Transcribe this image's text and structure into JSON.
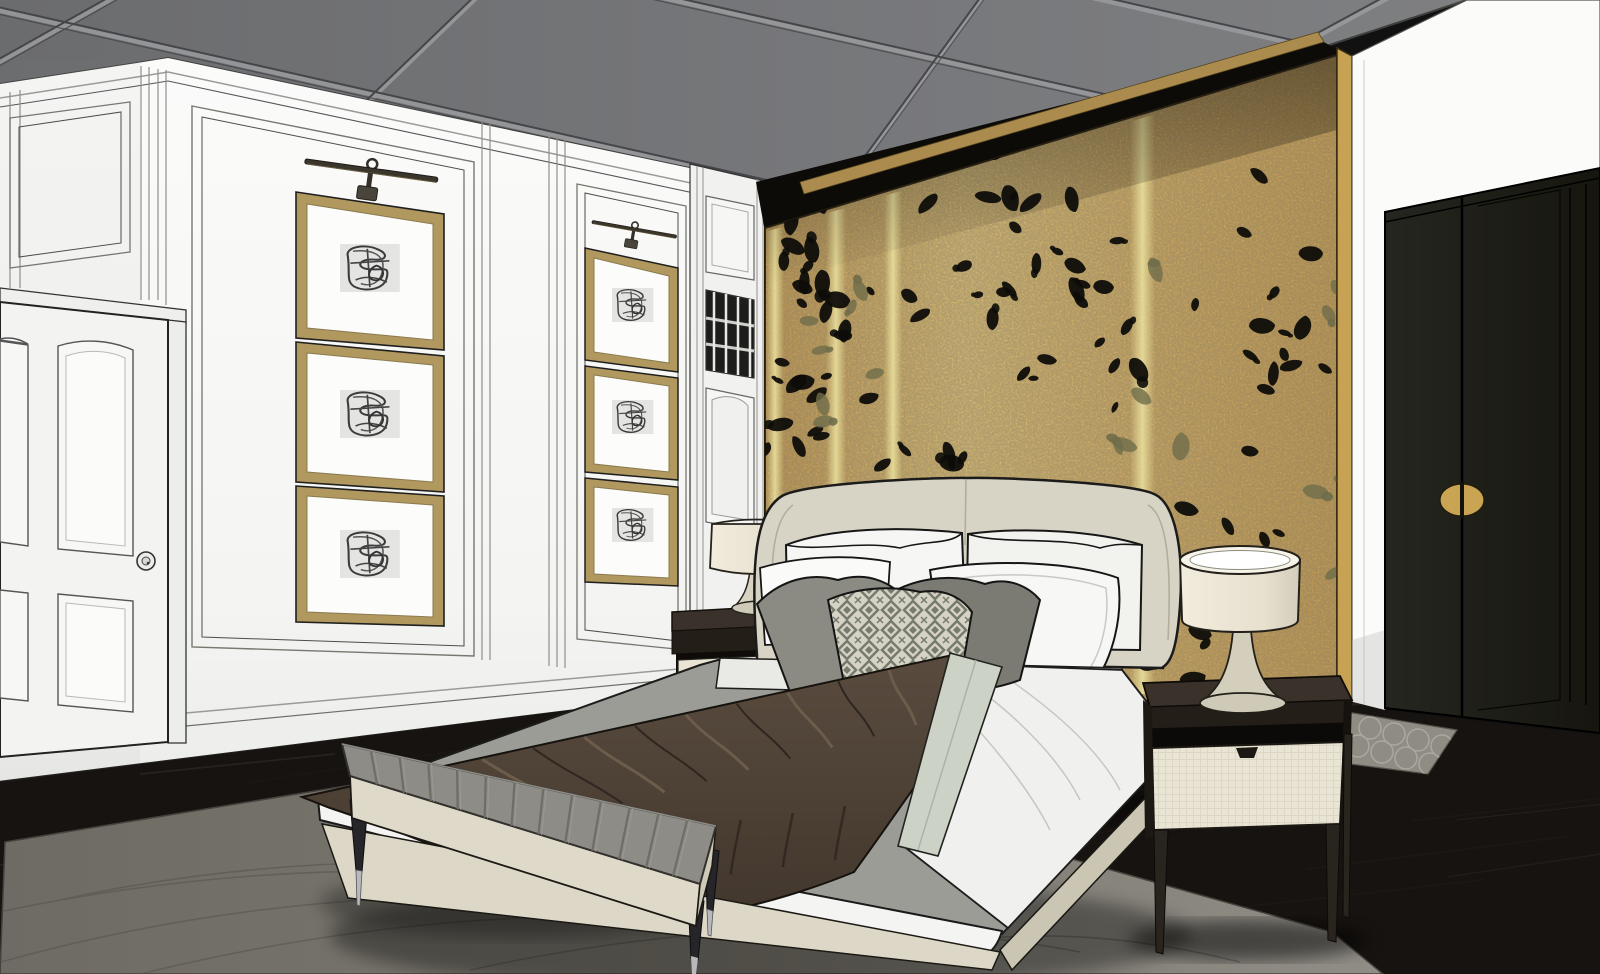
{
  "meta": {
    "title": "Bedroom interior design — stylized 3D render (two-point perspective)",
    "width": 1600,
    "height": 974
  },
  "palette": {
    "ceiling": "#717275",
    "ceiling_grid_dark": "#45454a",
    "ceiling_grid_light": "#9b9c9e",
    "wall_white": "#f6f6f4",
    "gold_base": "#c6a45e",
    "gold_light": "#dcc17a",
    "gold_strip": "#e8dc96",
    "gold_fascia": "#ab8c4e",
    "petal_black": "#0d0c09",
    "petal_olive": "#6f6d4a",
    "wardrobe": "#21211a",
    "handle_gold": "#c9a453",
    "floor": "#171310",
    "rug_main_dark": "#6e6b64",
    "rug_main_light": "#908d86",
    "rug_small": "#8f8c84",
    "headboard": "#d8d4c5",
    "bedding_white": "#f2f2f0",
    "sheet_gray": "#9c9c97",
    "throw_brown": "#4e4237",
    "throw_ridge": "#6b5c4b",
    "runner_sage": "#ccd3c6",
    "pillow_gray": "#8b8b83",
    "pillow_gray_dark": "#7b7b73",
    "bench_top": "#8e8c86",
    "bench_base": "#ded9c9",
    "nightstand_dark": "#241e18",
    "drawer_cream": "#e9e4d4",
    "lamp_shade": "#ece6d6",
    "frame_gold": "#b0985e",
    "door_white": "#f3f3f2"
  },
  "objects": {
    "door": {
      "panel_count": 6,
      "has_knob": true
    },
    "artwork": {
      "stacks": 2,
      "frames_per_stack": 3,
      "picture_lights": 2
    },
    "bed": {
      "white_pillows": 4,
      "gray_pillows": 2,
      "patterned_pillows": 1,
      "throw": "brown pleated"
    },
    "lamps": 2,
    "nightstands": 2,
    "bench": {
      "stripe_count": 13
    },
    "wardrobe": {
      "doors": 2,
      "handle": "round gold, split by door gap"
    },
    "rugs": {
      "main": "large gray area rug",
      "small": "gray trellis rug at wardrobe"
    }
  },
  "gold_wall": {
    "strips": [
      {
        "x1": 766,
        "x2": 784
      },
      {
        "x1": 826,
        "x2": 846
      },
      {
        "x1": 884,
        "x2": 902
      },
      {
        "x1": 1130,
        "x2": 1155
      }
    ],
    "petal_colors": {
      "black": "#0d0c09",
      "olive": "#6f6d4a"
    },
    "petal_clusters": [
      {
        "cx": 905,
        "cy": 215,
        "rx": 150,
        "ry": 110,
        "n": 34,
        "seed": 1,
        "color": "black"
      },
      {
        "cx": 1045,
        "cy": 300,
        "rx": 120,
        "ry": 140,
        "n": 18,
        "seed": 2,
        "color": "black"
      },
      {
        "cx": 868,
        "cy": 470,
        "rx": 105,
        "ry": 120,
        "n": 20,
        "seed": 3,
        "color": "black"
      },
      {
        "cx": 955,
        "cy": 608,
        "rx": 85,
        "ry": 55,
        "n": 7,
        "seed": 4,
        "color": "black"
      },
      {
        "cx": 1250,
        "cy": 295,
        "rx": 85,
        "ry": 165,
        "n": 15,
        "seed": 5,
        "color": "black"
      },
      {
        "cx": 1215,
        "cy": 555,
        "rx": 70,
        "ry": 85,
        "n": 9,
        "seed": 6,
        "color": "black"
      },
      {
        "cx": 1185,
        "cy": 655,
        "rx": 55,
        "ry": 35,
        "n": 5,
        "seed": 7,
        "color": "black"
      },
      {
        "cx": 800,
        "cy": 340,
        "rx": 55,
        "ry": 110,
        "n": 10,
        "seed": 8,
        "color": "black"
      },
      {
        "cx": 848,
        "cy": 330,
        "rx": 40,
        "ry": 120,
        "n": 7,
        "seed": 9,
        "color": "olive"
      },
      {
        "cx": 1150,
        "cy": 420,
        "rx": 40,
        "ry": 160,
        "n": 8,
        "seed": 10,
        "color": "olive"
      },
      {
        "cx": 1332,
        "cy": 420,
        "rx": 22,
        "ry": 200,
        "n": 6,
        "seed": 11,
        "color": "olive"
      }
    ]
  },
  "throw": {
    "pleat_count": 12,
    "hang_pleat_count": 8
  },
  "floor": {
    "grain_count": 36,
    "seed": 42
  }
}
